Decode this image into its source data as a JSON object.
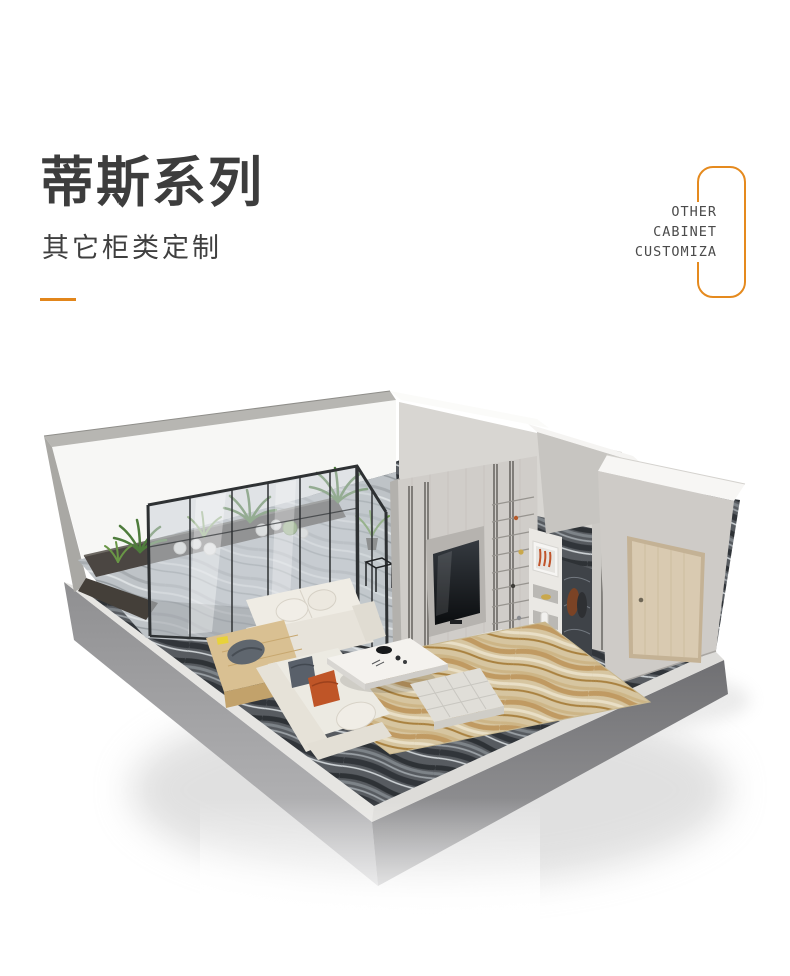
{
  "header": {
    "title": "蒂斯系列",
    "subtitle": "其它柜类定制",
    "underline_color": "#E2861B"
  },
  "badge": {
    "lines": [
      "OTHER",
      "CABINET",
      "CUSTOMIZA"
    ],
    "border_color": "#E58A1E",
    "text_color": "#4B4B4B"
  },
  "room": {
    "alt": "3D isometric cutaway render of a living room: glass-walled balcony with green plants, grey TV feature wall with shelving niches, wood entry door, cream L-shaped sofa with grey and rust pillows, marble coffee table, tan rug and dark veined marble floor on a floating concrete base"
  }
}
